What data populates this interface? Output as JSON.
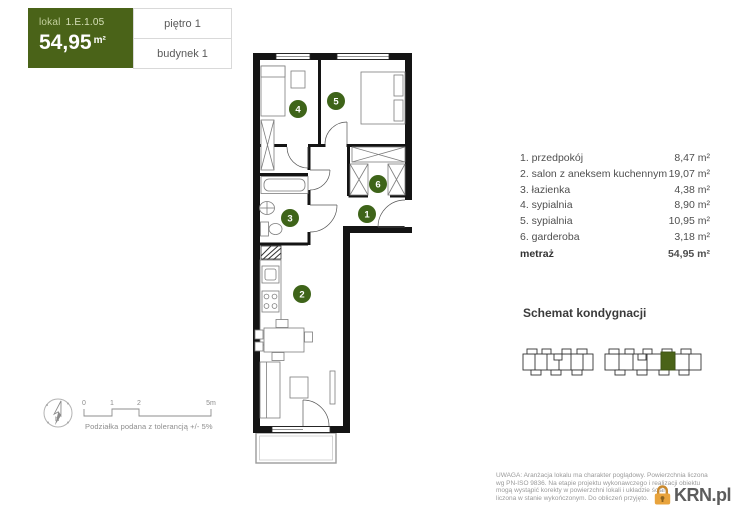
{
  "header": {
    "lokal_label": "lokal",
    "lokal_number": "1.E.1.05",
    "area_value": "54,95",
    "area_unit": "m²",
    "floor": "piętro 1",
    "building": "budynek 1"
  },
  "colors": {
    "accent_green": "#4a6318",
    "badge_green": "#3e6419",
    "logo_orange": "#e8a33c"
  },
  "legend": {
    "rooms": [
      {
        "number": "1",
        "label": "1. przedpokój",
        "area": "8,47 m²"
      },
      {
        "number": "2",
        "label": "2. salon z aneksem kuchennym",
        "area": "19,07 m²"
      },
      {
        "number": "3",
        "label": "3. łazienka",
        "area": "4,38 m²"
      },
      {
        "number": "4",
        "label": "4. sypialnia",
        "area": "8,90 m²"
      },
      {
        "number": "5",
        "label": "5. sypialnia",
        "area": "10,95 m²"
      },
      {
        "number": "6",
        "label": "6. garderoba",
        "area": "3,18 m²"
      }
    ],
    "total_label": "metraż",
    "total_area": "54,95 m²"
  },
  "schematic": {
    "title": "Schemat kondygnacji"
  },
  "compass": {
    "label": "N"
  },
  "scale": {
    "ticks": [
      "0",
      "1",
      "2",
      "5m"
    ],
    "caption": "Podziałka podana z tolerancją +/- 5%"
  },
  "footer": {
    "disclaimer_lines": [
      "UWAGA: Aranżacja lokalu ma charakter poglądowy. Powierzchnia liczona",
      "wg PN-ISO 9836. Na etapie projektu wykonawczego i realizacji obiektu",
      "mogą wystąpić korekty w powierzchni lokali i układzie ścian.",
      "liczona w stanie wykończonym. Do obliczeń przyjęto."
    ],
    "logo_text": "KRN.pl"
  }
}
